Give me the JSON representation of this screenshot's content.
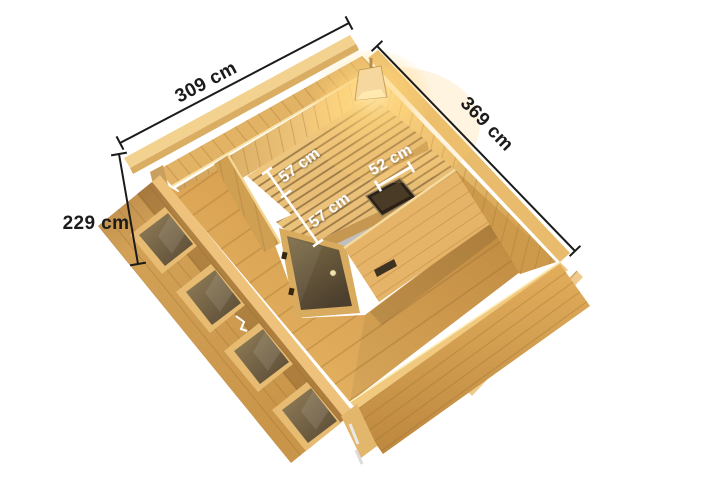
{
  "page": {
    "type": "product-dimension-diagram",
    "subject": "Top view 3D rendering of a wooden sauna cabin with interior benches, corner glass door, corner lamp and dimension annotations",
    "background": "#ffffff"
  },
  "annotations": {
    "outer_width_back": {
      "label": "309 cm"
    },
    "outer_depth_right": {
      "label": "369 cm"
    },
    "wall_height_left": {
      "label": "229 cm"
    },
    "bench_upper_depth": {
      "label": "57 cm"
    },
    "bench_lower_depth": {
      "label": "57 cm"
    },
    "bench_side_depth": {
      "label": "52 cm"
    }
  },
  "colors": {
    "dimension_line_outer": "#1b1b1b",
    "dimension_line_inner": "#ffffff",
    "wood_trim_light": "#f3d290",
    "wood_wall_mid": "#d9a95c",
    "wood_floor": "#d9a252",
    "wood_plank_seam": "#a87734",
    "bench_slat": "#eec47c",
    "door_glass": "#6e5c41",
    "heater_body": "#2b2116",
    "lamp_glow": "#ffe6a3"
  }
}
